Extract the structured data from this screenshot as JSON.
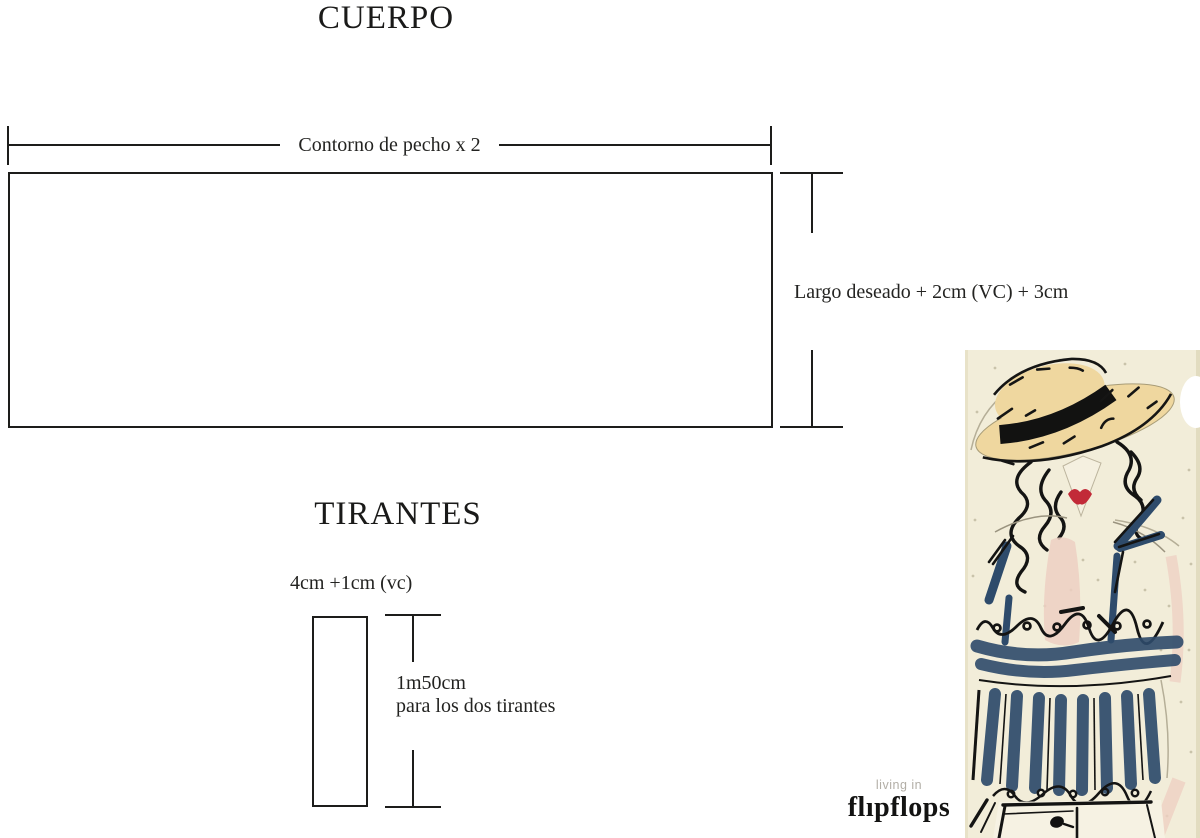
{
  "cuerpo": {
    "title": "CUERPO",
    "width_label": "Contorno de pecho x 2",
    "length_label": "Largo deseado + 2cm (VC) + 3cm"
  },
  "tirantes": {
    "title": "TIRANTES",
    "width_label": "4cm +1cm (vc)",
    "length_label_line1": "1m50cm",
    "length_label_line2": "para los dos tirantes"
  },
  "logo": {
    "tagline": "living in",
    "brand": "flıpflops"
  },
  "illustration": {
    "alt": "watercolor-ink fashion sketch: woman in straw boater hat with black band, curly dark hair, red lips, navy striped ruffled top with straps, white shorts",
    "colors": {
      "paper": "#f2edd9",
      "ink": "#1d1d1b",
      "straw": "#efd79f",
      "navy": "#2e4b6b",
      "lips_red": "#c22a38",
      "skin_pink": "#edcfc2",
      "logo_gray": "#b2aea6"
    }
  }
}
